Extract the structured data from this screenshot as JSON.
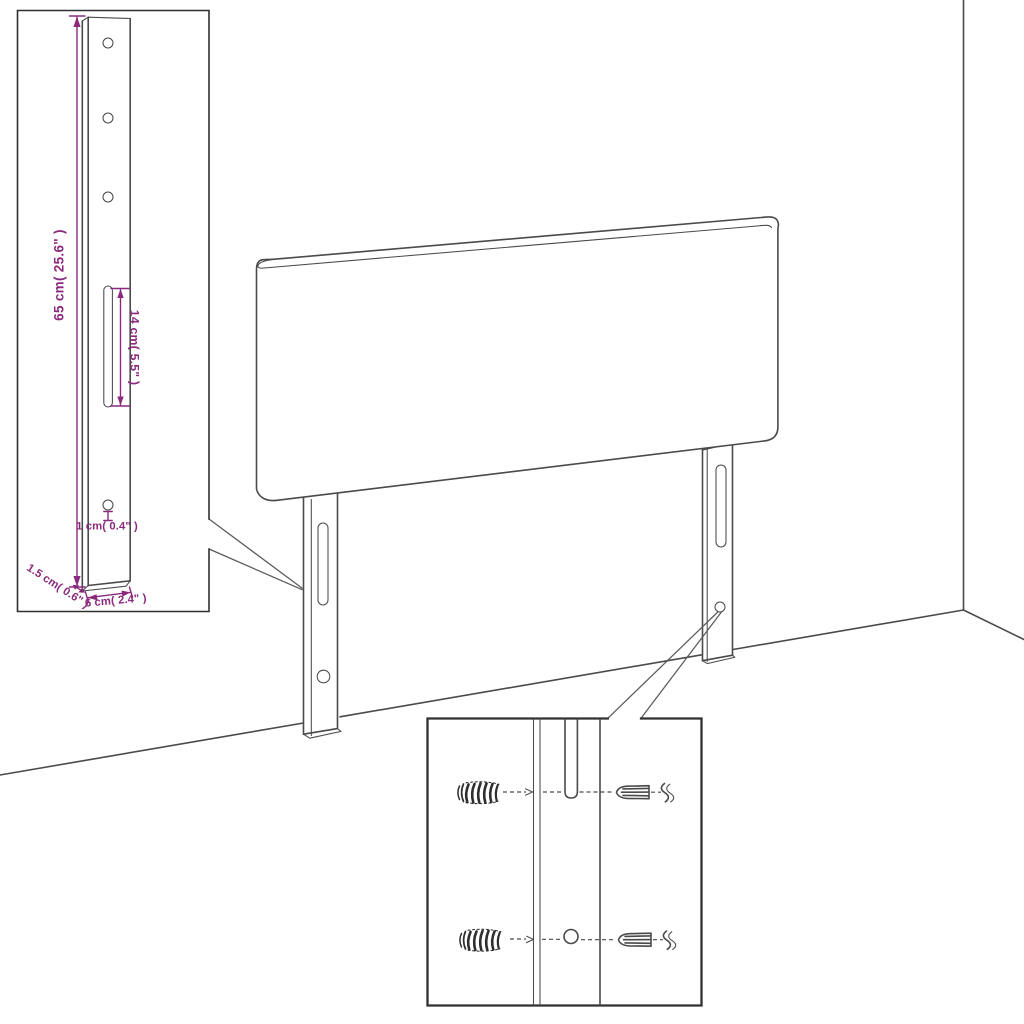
{
  "page": {
    "title": "Headboard dimension diagram",
    "background": "#ffffff"
  },
  "colors": {
    "dimension_accent": "#8B2A7D",
    "line_art": "#4A4A4A",
    "inset_border": "#303030"
  },
  "insets": {
    "leg_detail": {
      "dims": {
        "height": "65 cm( 25.6\" )",
        "slot": "14 cm( 5.5\" )",
        "hole": "1 cm( 0.4\" )",
        "thickness": "1.5 cm( 0.6\" )",
        "width": "6 cm( 2.4\" )"
      },
      "features": [
        "three-mounting-holes",
        "adjustment-slot",
        "lower-hole"
      ]
    },
    "mounting_detail": {
      "parts": [
        "wall-plug-upper",
        "screw-upper",
        "wall-plug-lower",
        "screw-lower",
        "slot",
        "hole"
      ]
    }
  },
  "main": {
    "subject": "headboard-panel",
    "features": [
      "left-mounting-leg",
      "right-mounting-leg",
      "wall-corner",
      "floor-line"
    ]
  }
}
